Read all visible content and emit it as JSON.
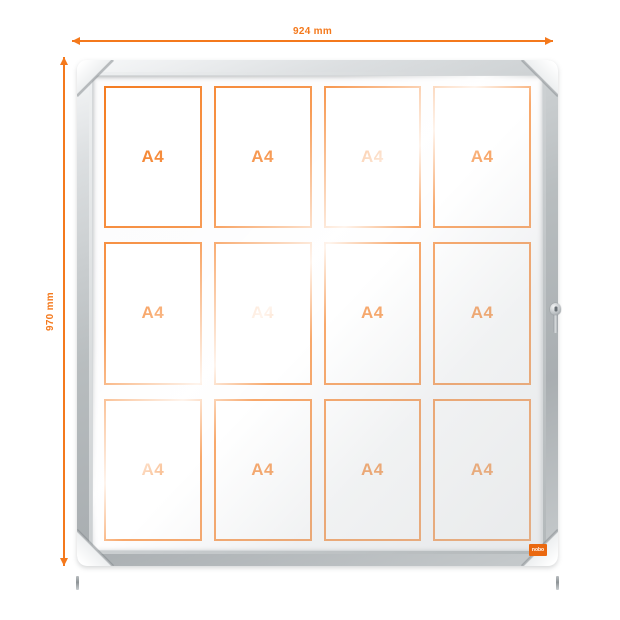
{
  "product": {
    "brand_logo": "nobo"
  },
  "annotations": {
    "width_label": "924 mm",
    "height_label": "970 mm"
  },
  "board": {
    "columns": 4,
    "rows": 3,
    "sheets": [
      "A4",
      "A4",
      "A4",
      "A4",
      "A4",
      "A4",
      "A4",
      "A4",
      "A4",
      "A4",
      "A4",
      "A4"
    ]
  },
  "colors": {
    "accent_orange": "#F4791C",
    "frame_silver": "#B6BBBD",
    "logo_orange": "#EA680F",
    "background": "#FFFFFF"
  }
}
